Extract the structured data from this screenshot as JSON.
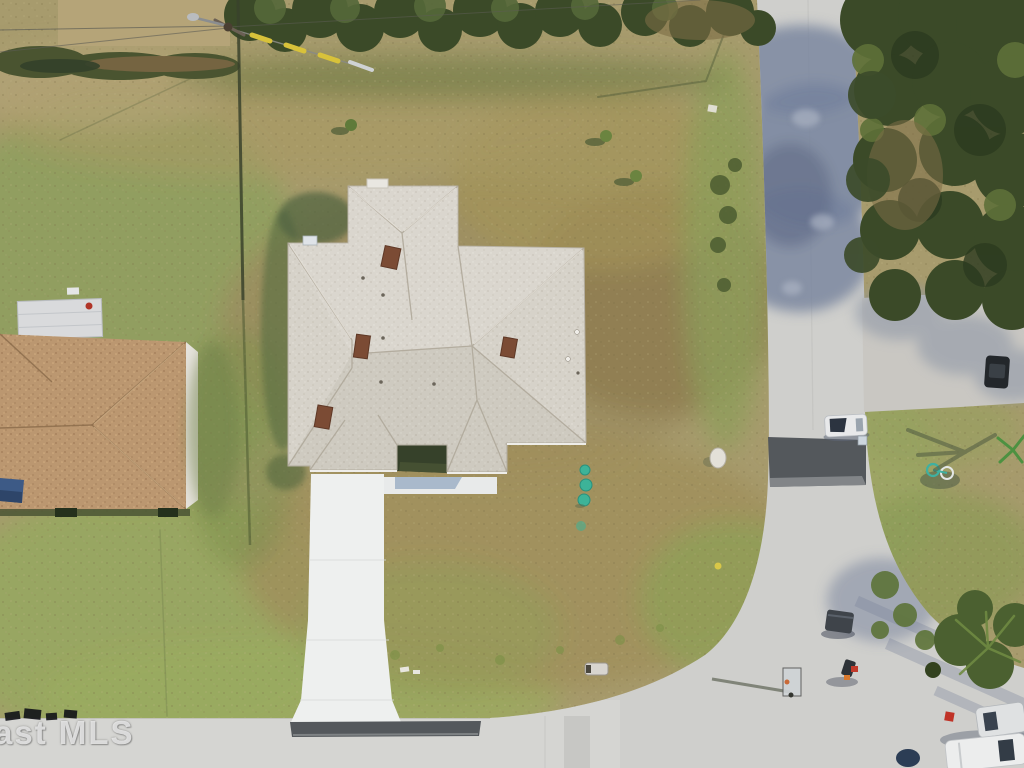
{
  "image": {
    "type": "aerial-drone-photograph",
    "description": "Overhead aerial view of a single-family home on a corner lot with long white driveway, dry lawn, neighboring brown-roof house at left, and two intersecting residential streets",
    "watermark": "ast MLS"
  },
  "palette": {
    "grass_base": "#a79b6d",
    "grass_green": "#8d9c5c",
    "grass_bright": "#9aab5f",
    "grass_brown": "#9c8c5e",
    "road": "#cfcfcc",
    "road_light": "#dbdad7",
    "road_shadow": "#76829c",
    "asphalt": "#54585c",
    "roof_main": "#d6d2c9",
    "roof_neighbor": "#bb9770",
    "driveway": "#eef0ef",
    "tree_dark": "#3b4a28",
    "tree_mid": "#556839",
    "teal_shrub": "#3db398",
    "vent_brown": "#7b4b34",
    "watermark_color": "rgba(235,235,235,0.85)"
  },
  "scene_objects": [
    "main-house-hip-roof",
    "front-driveway",
    "entry-walkway",
    "left-neighbor-house",
    "vertical-street-right",
    "horizontal-street-bottom",
    "street-intersection",
    "utility-pole-with-wires",
    "chain-link-fence-line",
    "top-tree-row",
    "right-tree-block",
    "teal-shrub-markers",
    "basketball-hoop",
    "trash-bin",
    "white-car-on-street",
    "dark-car-in-shade",
    "corner-parked-vehicles",
    "bicycle-on-lawn",
    "asphalt-patch-band",
    "neighbor-concrete-driveway",
    "culvert-pipe",
    "white-rock",
    "mls-watermark"
  ]
}
